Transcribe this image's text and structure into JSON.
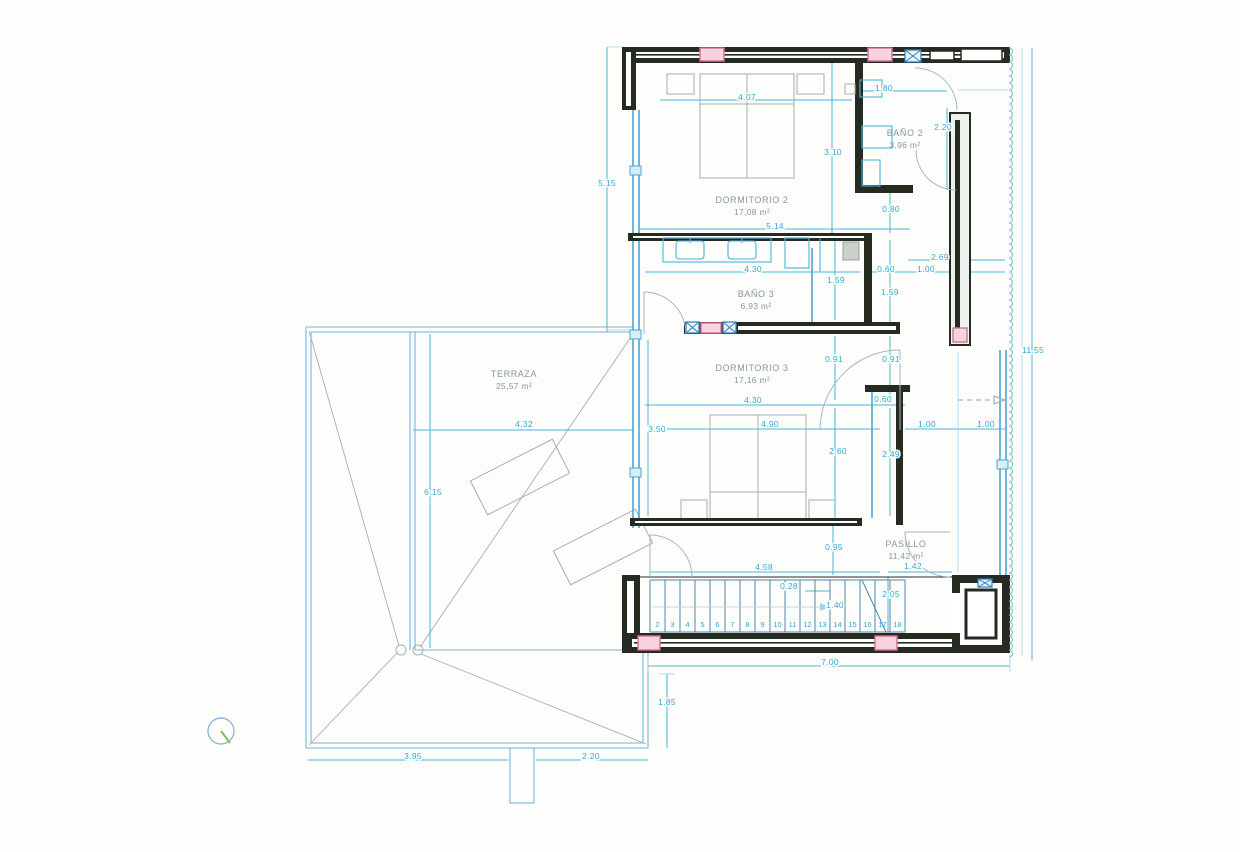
{
  "colors": {
    "paper": "#fdfdfb",
    "wall": "#262b22",
    "dimension_text": "#2fa8cf",
    "dimension_line": "#49b6d8",
    "glazing": "#4da3d4",
    "room_label": "#86979e",
    "furniture": "#a9adaf",
    "roof": "#a8acae",
    "column_fill": "#f6d3de",
    "column_stroke": "#d97095",
    "boundary_blue": "#74b5da",
    "boundary_scallop": "#7cc5c9"
  },
  "rooms": [
    {
      "name": "DORMITORIO 2",
      "area": "17,08 m²"
    },
    {
      "name": "BAÑO 2",
      "area": "3,96 m²"
    },
    {
      "name": "BAÑO 3",
      "area": "6,93 m²"
    },
    {
      "name": "DORMITORIO 3",
      "area": "17,16 m²"
    },
    {
      "name": "TERRAZA",
      "area": "25,57 m²"
    },
    {
      "name": "PASILLO",
      "area": "11,42 m²"
    }
  ],
  "annotations": [
    {
      "t": "5.15",
      "x": 607,
      "y": 186
    },
    {
      "t": "4.07",
      "x": 747,
      "y": 100
    },
    {
      "t": "1.80",
      "x": 884,
      "y": 91
    },
    {
      "t": "2.20",
      "x": 943,
      "y": 130
    },
    {
      "t": "3.10",
      "x": 833,
      "y": 155
    },
    {
      "t": "0.80",
      "x": 891,
      "y": 212
    },
    {
      "t": "5.14",
      "x": 775,
      "y": 229
    },
    {
      "t": "4.30",
      "x": 753,
      "y": 272
    },
    {
      "t": "1.59",
      "x": 836,
      "y": 283
    },
    {
      "t": "0.60",
      "x": 886,
      "y": 272
    },
    {
      "t": "1.00",
      "x": 926,
      "y": 272
    },
    {
      "t": "2.69",
      "x": 940,
      "y": 260
    },
    {
      "t": "1.59",
      "x": 890,
      "y": 295
    },
    {
      "t": "0.91",
      "x": 834,
      "y": 362
    },
    {
      "t": "0.91",
      "x": 891,
      "y": 362
    },
    {
      "t": "4.30",
      "x": 753,
      "y": 403
    },
    {
      "t": "0.60",
      "x": 883,
      "y": 402
    },
    {
      "t": "4.90",
      "x": 770,
      "y": 427
    },
    {
      "t": "1.00",
      "x": 927,
      "y": 427
    },
    {
      "t": "1.00",
      "x": 986,
      "y": 427
    },
    {
      "t": "3.50",
      "x": 657,
      "y": 432
    },
    {
      "t": "2.60",
      "x": 838,
      "y": 454
    },
    {
      "t": "2.49",
      "x": 891,
      "y": 457
    },
    {
      "t": "4.32",
      "x": 524,
      "y": 427
    },
    {
      "t": "6.15",
      "x": 433,
      "y": 495
    },
    {
      "t": "0.95",
      "x": 834,
      "y": 550
    },
    {
      "t": "4.58",
      "x": 764,
      "y": 570
    },
    {
      "t": "1.42",
      "x": 913,
      "y": 569
    },
    {
      "t": "0.28",
      "x": 789,
      "y": 589
    },
    {
      "t": "2.05",
      "x": 891,
      "y": 597
    },
    {
      "t": "1.40",
      "x": 835,
      "y": 608
    },
    {
      "t": "7.00",
      "x": 830,
      "y": 665
    },
    {
      "t": "1.85",
      "x": 667,
      "y": 705
    },
    {
      "t": "11.55",
      "x": 1033,
      "y": 353
    },
    {
      "t": "3.95",
      "x": 413,
      "y": 759
    },
    {
      "t": "2.20",
      "x": 591,
      "y": 759
    }
  ],
  "stairs": {
    "steps": [
      "2",
      "3",
      "4",
      "5",
      "6",
      "7",
      "8",
      "9",
      "10",
      "11",
      "12",
      "13",
      "14",
      "15",
      "16",
      "17",
      "18"
    ]
  }
}
